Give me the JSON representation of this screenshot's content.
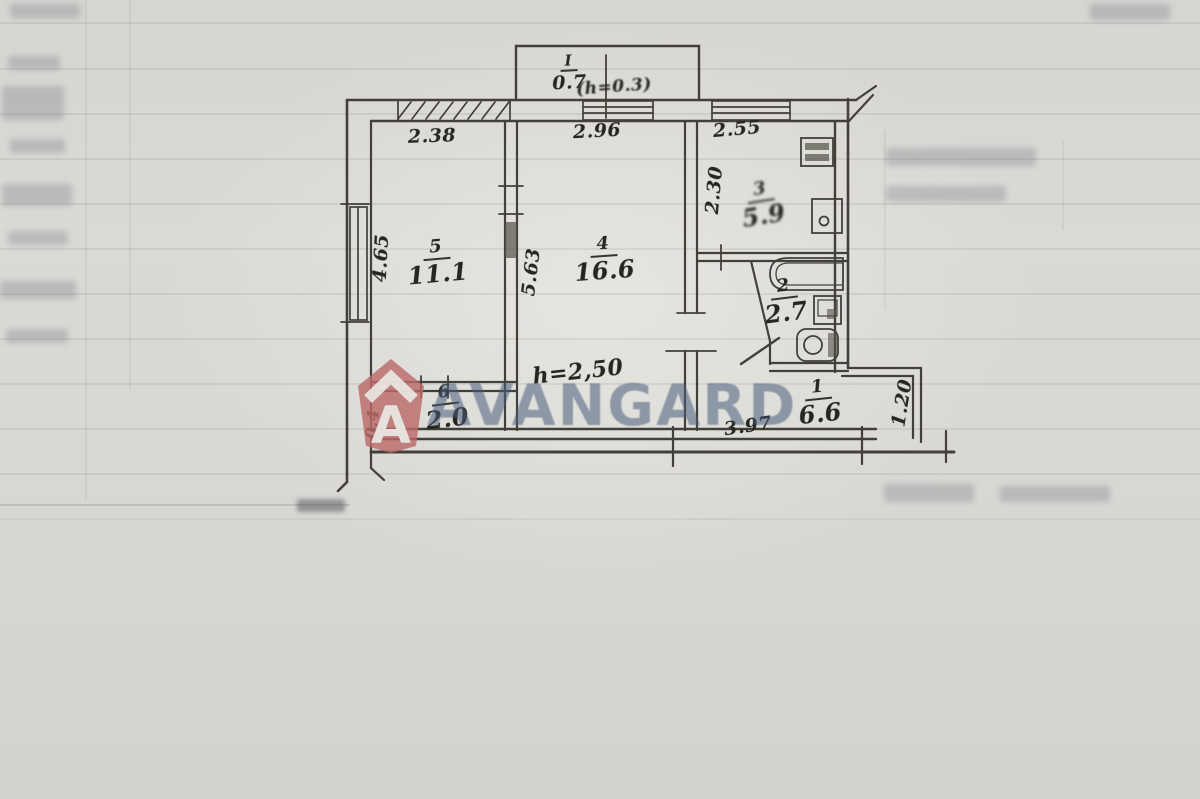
{
  "document": {
    "type_note": "scanned apartment floor plan",
    "paper_color": "#d8d7d3",
    "ink_color": "#37352e"
  },
  "watermark": {
    "text": "AVANGARD",
    "text_color": "#485d7b",
    "logo_letter": "A",
    "logo_color": "#bb6a6a"
  },
  "floorplan": {
    "rooms": {
      "r1": {
        "number": "1",
        "area": "6.6"
      },
      "r2": {
        "number": "2",
        "area": "2.7"
      },
      "r3": {
        "number": "3",
        "area": "5.9"
      },
      "r4": {
        "number": "4",
        "area": "16.6"
      },
      "r5": {
        "number": "5",
        "area": "11.1"
      },
      "r6": {
        "number": "6",
        "area": "2.0"
      },
      "balcony": {
        "number": "I",
        "area": "0.7"
      }
    },
    "annotations": {
      "balcony_height": "(h=0.3)",
      "ceiling_height": "h=2,50"
    },
    "dimensions": {
      "top_left": "2.38",
      "top_center": "2.96",
      "top_right": "2.55",
      "kitchen_depth": "2.30",
      "left_wall": "4.65",
      "partition": "5.63",
      "hall_width": "3.97",
      "niche_width": "1.20",
      "left_bottom": "0.4"
    }
  }
}
